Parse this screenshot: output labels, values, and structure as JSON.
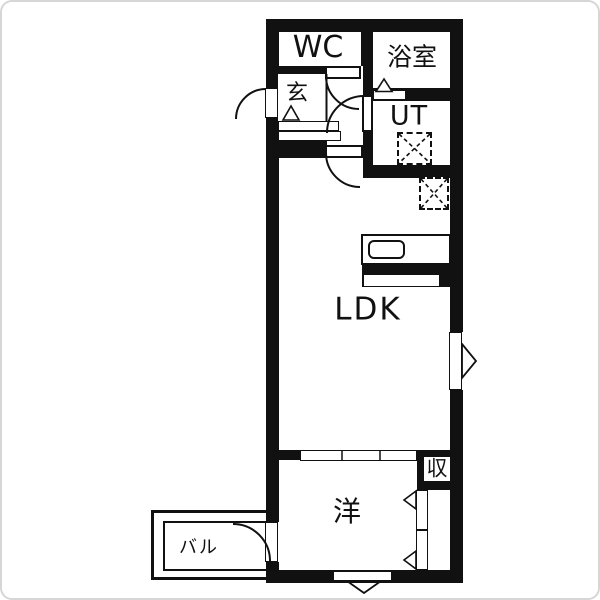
{
  "rooms": {
    "wc": "WC",
    "bath": "浴室",
    "entrance": "玄",
    "utility": "UT",
    "ldk": "LDK",
    "western": "洋",
    "storage": "収",
    "balcony": "バル"
  },
  "colors": {
    "wall": "#111111",
    "floor": "#ffffff",
    "frame": "#d6d6d6"
  },
  "fixtures": {
    "door_arc": "hinged-door-swing",
    "appliance_box": "dashed-appliance-space",
    "sink": "kitchen-sink",
    "triangle": "entry-step-marker",
    "sliding_door": "three-panel-sliding-door"
  }
}
